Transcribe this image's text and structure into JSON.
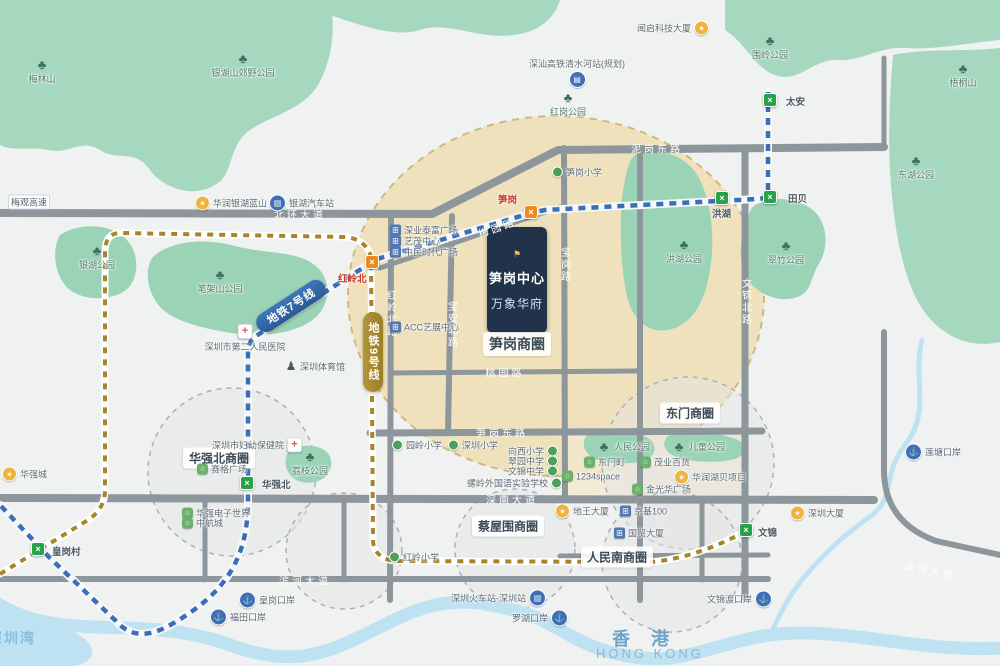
{
  "project": {
    "flag": "⚑",
    "line1": "笋岗中心",
    "line2": "万象华府"
  },
  "regions": {
    "hk": "香 港",
    "hk_en": "HONG KONG",
    "bay": "深圳湾"
  },
  "metro": {
    "line7_label": "地铁7号线",
    "line9_label": "地铁9号线",
    "stations": [
      {
        "name": "太安",
        "x": 770,
        "y": 100,
        "variant": "green",
        "lx": 786,
        "ly": 101
      },
      {
        "name": "田贝",
        "x": 770,
        "y": 197,
        "variant": "green",
        "lx": 788,
        "ly": 198
      },
      {
        "name": "洪湖",
        "x": 722,
        "y": 198,
        "variant": "green",
        "lx": 712,
        "ly": 213
      },
      {
        "name": "笋岗",
        "x": 531,
        "y": 212,
        "variant": "orange",
        "lx": 498,
        "ly": 199,
        "red": true
      },
      {
        "name": "红岭北",
        "x": 372,
        "y": 262,
        "variant": "orange",
        "lx": 338,
        "ly": 278,
        "red": true
      },
      {
        "name": "华强北",
        "x": 247,
        "y": 483,
        "variant": "green",
        "lx": 262,
        "ly": 484
      },
      {
        "name": "文锦",
        "x": 746,
        "y": 530,
        "variant": "green",
        "lx": 758,
        "ly": 532
      },
      {
        "name": "皇岗村",
        "x": 38,
        "y": 549,
        "variant": "green",
        "lx": 52,
        "ly": 551
      }
    ]
  },
  "districts": [
    {
      "label": "笋岗商圈",
      "x": 517,
      "y": 344,
      "size": 14
    },
    {
      "label": "华强北商圈",
      "x": 219,
      "y": 458,
      "size": 12
    },
    {
      "label": "东门商圈",
      "x": 690,
      "y": 413,
      "size": 12
    },
    {
      "label": "蔡屋围商圈",
      "x": 508,
      "y": 526,
      "size": 12
    },
    {
      "label": "人民南商圈",
      "x": 617,
      "y": 557,
      "size": 12
    }
  ],
  "roads": [
    {
      "name": "北环大道",
      "x": 300,
      "y": 214
    },
    {
      "name": "泥岗东路",
      "x": 657,
      "y": 148
    },
    {
      "name": "梅园路",
      "x": 497,
      "y": 227,
      "rot": -19
    },
    {
      "name": "宝安北路",
      "x": 451,
      "y": 325,
      "vertical": true
    },
    {
      "name": "红岭北路",
      "x": 390,
      "y": 314,
      "vertical": true
    },
    {
      "name": "宝岗路",
      "x": 564,
      "y": 265,
      "vertical": true
    },
    {
      "name": "文锦北路",
      "x": 745,
      "y": 302,
      "vertical": true
    },
    {
      "name": "桃园路",
      "x": 505,
      "y": 372
    },
    {
      "name": "笋岗东路",
      "x": 502,
      "y": 432
    },
    {
      "name": "深南大道",
      "x": 512,
      "y": 499
    },
    {
      "name": "滨河大道",
      "x": 305,
      "y": 580
    },
    {
      "name": "滨河大道",
      "x": 930,
      "y": 570,
      "rot": 12
    }
  ],
  "pois": [
    {
      "type": "yellow",
      "label": "华润银湖蓝山",
      "x": 203,
      "y": 203
    },
    {
      "type": "bus",
      "label": "银湖汽车站",
      "x": 277,
      "y": 203
    },
    {
      "type": "yellow",
      "label": "闻启科技大厦",
      "x": 700,
      "y": 28,
      "side": "left"
    },
    {
      "type": "train",
      "label": "深汕高铁清水河站(规划)",
      "x": 577,
      "y": 79,
      "side": "above"
    },
    {
      "type": "tree",
      "label": "红岗公园",
      "x": 568,
      "y": 99,
      "side": "below"
    },
    {
      "type": "tree",
      "label": "梅林山",
      "x": 42,
      "y": 66,
      "side": "below"
    },
    {
      "type": "tree",
      "label": "银湖山郊野公园",
      "x": 243,
      "y": 60,
      "side": "below"
    },
    {
      "type": "tree",
      "label": "围岭公园",
      "x": 770,
      "y": 42,
      "side": "below"
    },
    {
      "type": "tree",
      "label": "梧桐山",
      "x": 963,
      "y": 70,
      "side": "below"
    },
    {
      "type": "tree",
      "label": "东湖公园",
      "x": 916,
      "y": 162,
      "side": "below"
    },
    {
      "type": "tree",
      "label": "银湖公园",
      "x": 97,
      "y": 252,
      "side": "below"
    },
    {
      "type": "tree",
      "label": "笔架山公园",
      "x": 220,
      "y": 276,
      "side": "below"
    },
    {
      "type": "tree",
      "label": "洪湖公园",
      "x": 684,
      "y": 246,
      "side": "below"
    },
    {
      "type": "tree",
      "label": "翠竹公园",
      "x": 786,
      "y": 247,
      "side": "below"
    },
    {
      "type": "tree",
      "label": "荔枝公园",
      "x": 310,
      "y": 458,
      "side": "below"
    },
    {
      "type": "tree",
      "label": "人民公园",
      "x": 605,
      "y": 446
    },
    {
      "type": "tree",
      "label": "儿童公园",
      "x": 680,
      "y": 446
    },
    {
      "type": "hospital",
      "label": "深圳市第二人民医院",
      "x": 245,
      "y": 333,
      "side": "below"
    },
    {
      "type": "hospital",
      "label": "深圳市妇幼保健院",
      "x": 293,
      "y": 445,
      "side": "left"
    },
    {
      "type": "person",
      "label": "深圳体育馆",
      "x": 293,
      "y": 366
    },
    {
      "type": "building",
      "label": "深业泰富广场",
      "x": 398,
      "y": 230
    },
    {
      "type": "building",
      "label": "艺茂中心",
      "x": 398,
      "y": 241
    },
    {
      "type": "building",
      "label": "中民时代广场",
      "x": 398,
      "y": 252
    },
    {
      "type": "building",
      "label": "ACC艺展中心",
      "x": 398,
      "y": 327
    },
    {
      "type": "school",
      "label": "笋岗小学",
      "x": 560,
      "y": 172
    },
    {
      "type": "school",
      "label": "园岭小学",
      "x": 400,
      "y": 445
    },
    {
      "type": "school",
      "label": "深圳小学",
      "x": 456,
      "y": 445
    },
    {
      "type": "school",
      "label": "向西小学",
      "x": 549,
      "y": 451,
      "side": "left"
    },
    {
      "type": "school",
      "label": "翠园中学",
      "x": 549,
      "y": 461,
      "side": "left"
    },
    {
      "type": "school",
      "label": "文锦中学",
      "x": 549,
      "y": 471,
      "side": "left"
    },
    {
      "type": "school",
      "label": "螺岭外国语实验学校",
      "x": 553,
      "y": 483,
      "side": "left"
    },
    {
      "type": "school",
      "label": "红岭小学",
      "x": 397,
      "y": 557
    },
    {
      "type": "shop",
      "label": "赛格广场",
      "x": 205,
      "y": 469
    },
    {
      "type": "shop",
      "label": "华强电子世界",
      "x": 190,
      "y": 513
    },
    {
      "type": "shop",
      "label": "中航城",
      "x": 190,
      "y": 523
    },
    {
      "type": "shop",
      "label": "东门町",
      "x": 592,
      "y": 462
    },
    {
      "type": "shop",
      "label": "茂业百货",
      "x": 648,
      "y": 462
    },
    {
      "type": "shop",
      "label": "1234space",
      "x": 570,
      "y": 476
    },
    {
      "type": "shop",
      "label": "金光华广场",
      "x": 640,
      "y": 489
    },
    {
      "type": "yellow",
      "label": "华润湖贝项目",
      "x": 682,
      "y": 477
    },
    {
      "type": "yellow",
      "label": "地王大厦",
      "x": 563,
      "y": 511
    },
    {
      "type": "building",
      "label": "京基100",
      "x": 628,
      "y": 511
    },
    {
      "type": "building",
      "label": "国贸大厦",
      "x": 622,
      "y": 533
    },
    {
      "type": "yellow",
      "label": "深圳大厦",
      "x": 798,
      "y": 513
    },
    {
      "type": "port",
      "label": "莲塘口岸",
      "x": 913,
      "y": 452
    },
    {
      "type": "port",
      "label": "文锦渡口岸",
      "x": 763,
      "y": 599,
      "side": "left"
    },
    {
      "type": "train",
      "label": "深圳火车站-深圳站",
      "x": 537,
      "y": 598,
      "side": "left"
    },
    {
      "type": "port",
      "label": "罗湖口岸",
      "x": 559,
      "y": 618,
      "side": "left"
    },
    {
      "type": "port",
      "label": "福田口岸",
      "x": 218,
      "y": 617
    },
    {
      "type": "port",
      "label": "皇岗口岸",
      "x": 247,
      "y": 600
    },
    {
      "type": "yellow",
      "label": "华强城",
      "x": 10,
      "y": 474
    },
    {
      "type": "sign",
      "label": "梅观高速",
      "x": 16,
      "y": 202
    }
  ]
}
